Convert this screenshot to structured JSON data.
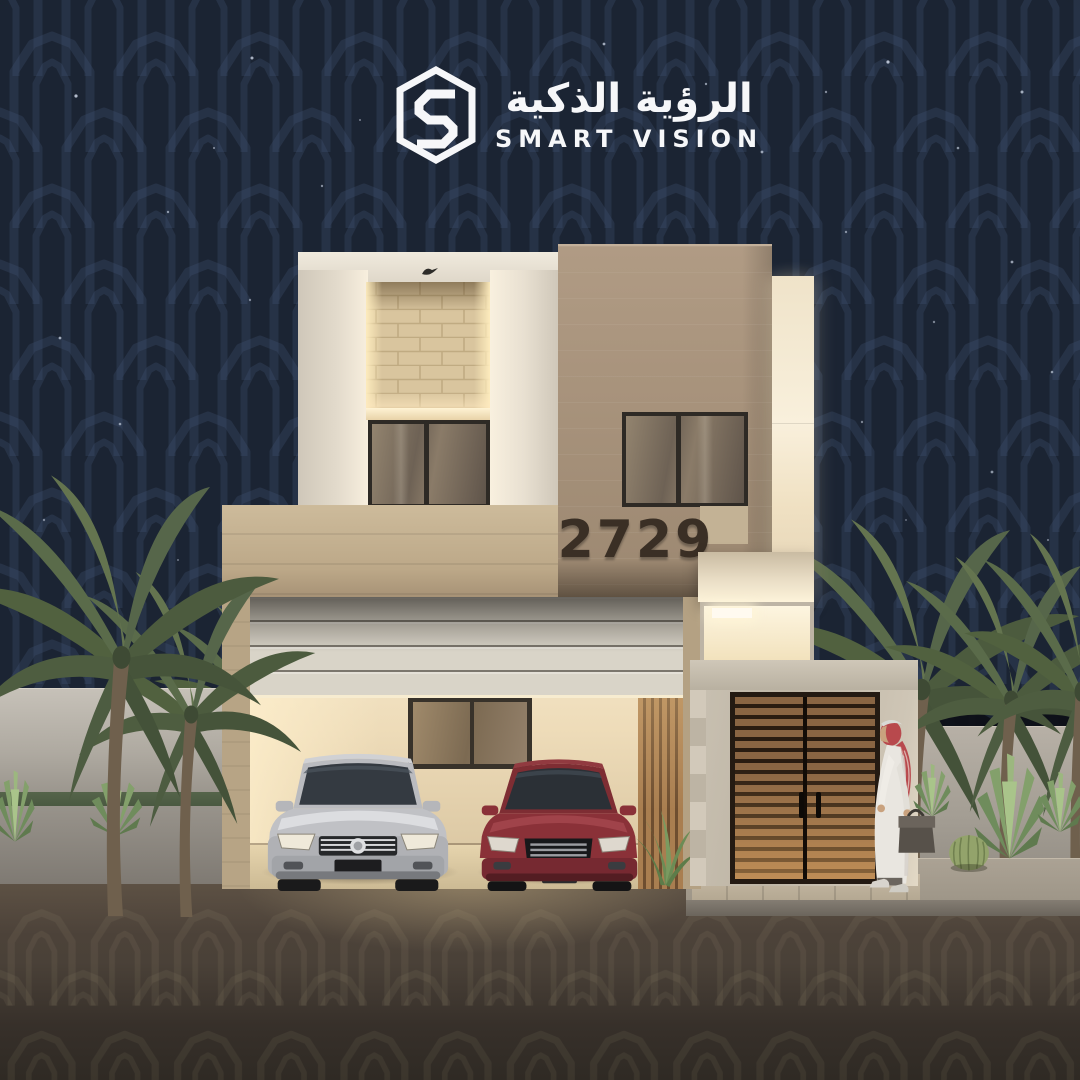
{
  "logo": {
    "icon": "hexagon-s-monogram-icon",
    "title_arabic": "الرؤية الذكية",
    "title_english": "SMART VISION"
  },
  "building": {
    "house_number": "2729"
  },
  "colors": {
    "sky_navy": "#1b2433",
    "pattern_line": "#46587c",
    "facade_white": "#e9e2d5",
    "facade_stone": "#a8937c",
    "brick_accent": "#d9c59e",
    "warm_light": "#fdf3da",
    "door_wood": "#8a6543",
    "car_silver": "#c0c1c5",
    "car_red": "#8a3138",
    "ghutra_red": "#b8494d",
    "road_asphalt": "#4a4138",
    "fence_gray": "#b3aca2",
    "palm_green": "#5c6c49"
  }
}
